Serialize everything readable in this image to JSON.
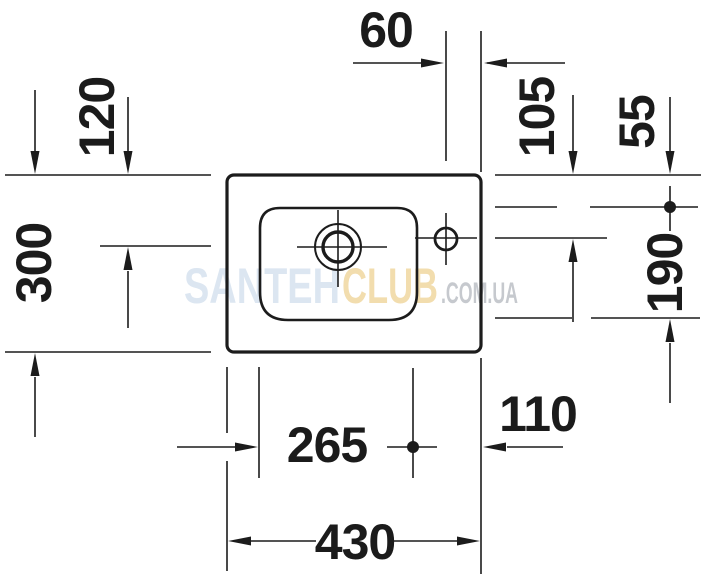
{
  "drawing": {
    "type": "washbasin top-view dimension drawing",
    "unit": "mm",
    "labels": {
      "tap_to_right_edge": "60",
      "rear_to_tap_center": "105",
      "rear_to_basin_top": "55",
      "rear_to_drain_center": "120",
      "overall_depth": "300",
      "basin_inner_depth": "190",
      "basin_inner_width": "265",
      "basin_to_right_edge": "110",
      "overall_width": "430"
    },
    "watermark": {
      "brand_left": "SANTEH",
      "brand_right": "CLUB",
      "domain": ".COM.UA"
    },
    "colors": {
      "line": "#1c1c1c",
      "background": "#ffffff",
      "watermark_blue": "#dce6f1",
      "watermark_orange": "#f2ddae",
      "watermark_gray": "#c6c9ce"
    }
  }
}
